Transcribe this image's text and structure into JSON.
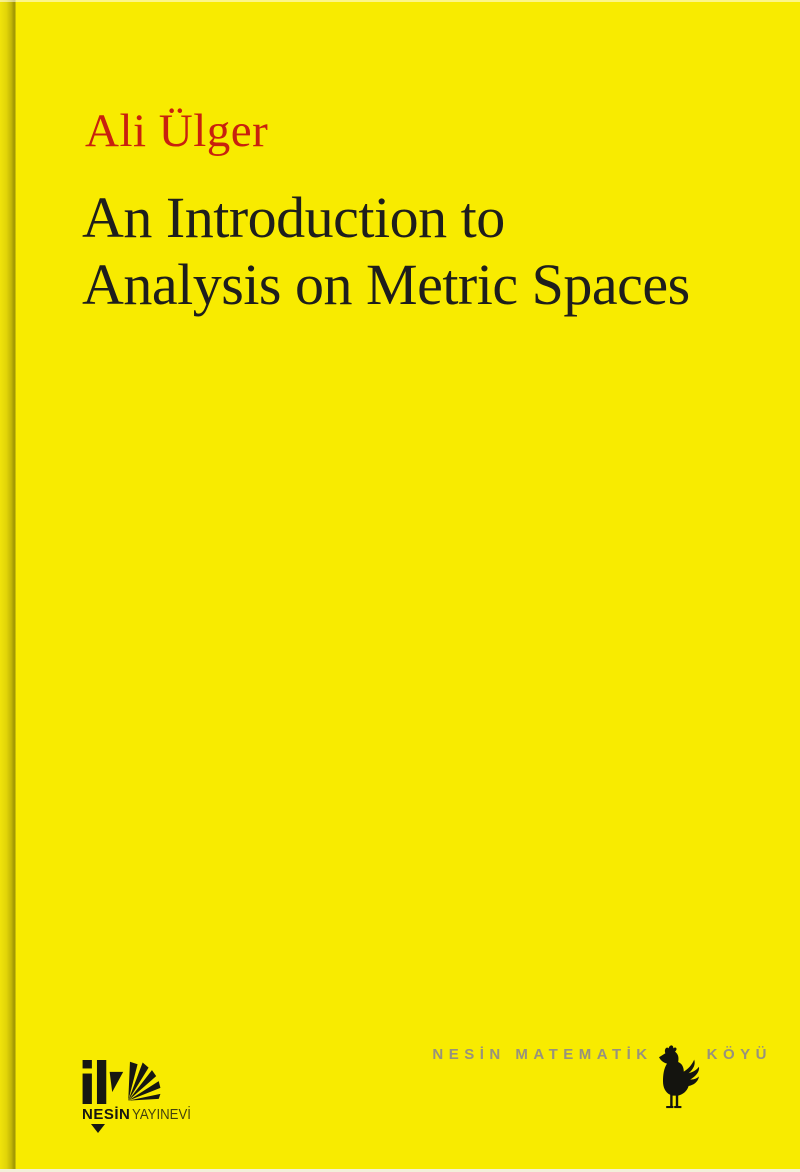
{
  "cover": {
    "author": "Ali Ülger",
    "title_line1": "An Introduction to",
    "title_line2": "Analysis on Metric Spaces",
    "colors": {
      "background_yellow": "#f8eb00",
      "author_red": "#c8210e",
      "title_dark": "#1e1e1c",
      "footer_gray": "#97927d",
      "logo_black": "#171712"
    }
  },
  "publisher_logo": {
    "mark_icon": "nesin-yayinevi-monogram",
    "name_bold": "NESİN",
    "name_light": "YAYINEVİ"
  },
  "footer_right": {
    "text_left": "NESİN MATEMATİK",
    "text_right": "KÖYÜ",
    "icon": "rooster-silhouette"
  }
}
